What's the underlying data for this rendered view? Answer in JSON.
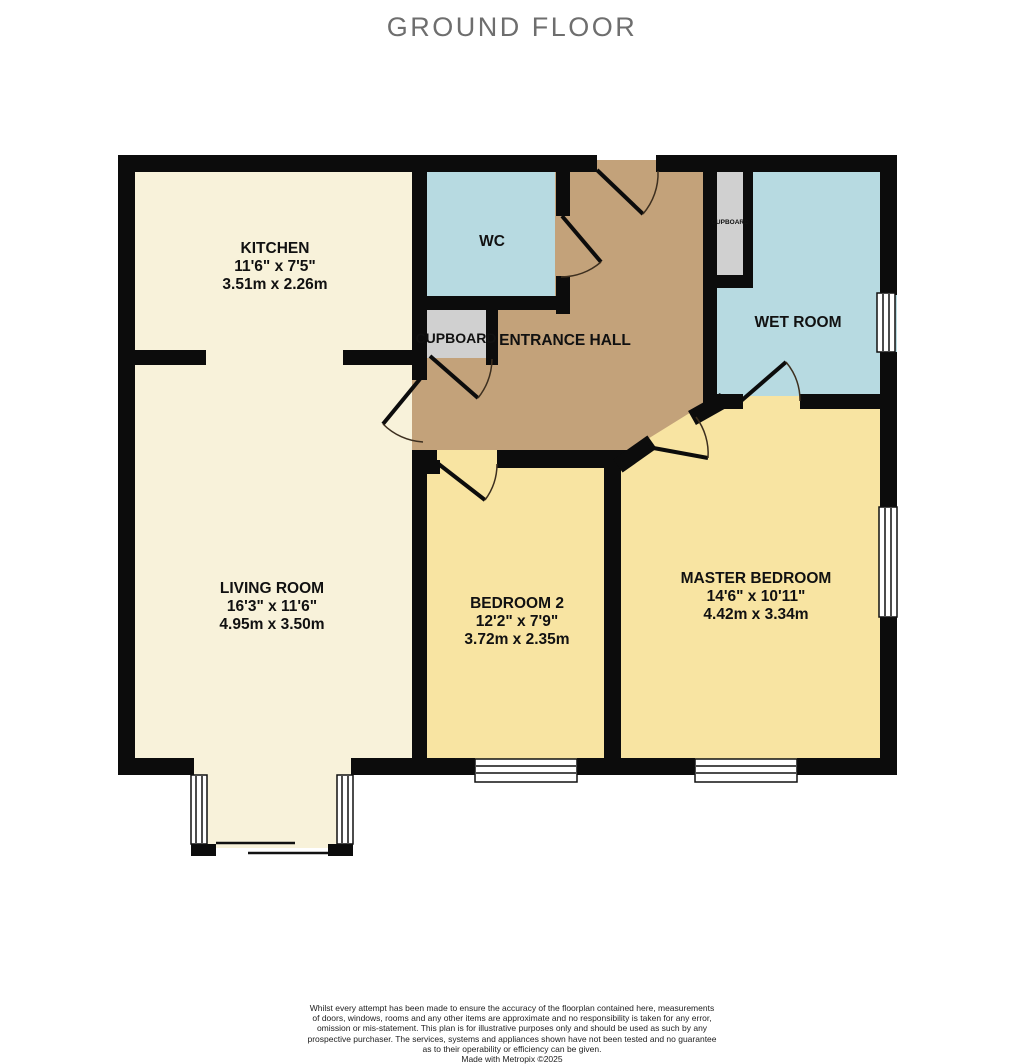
{
  "title": "GROUND FLOOR",
  "colors": {
    "wall": "#0c0c0c",
    "cream": "#f8f2da",
    "blue": "#b7dae1",
    "tan": "#c3a27a",
    "yellow": "#f8e4a2",
    "gray": "#d0d0d0",
    "door_arc": "#3d2f1f",
    "title_gray": "#6e6e6e"
  },
  "rooms": {
    "kitchen": {
      "name": "KITCHEN",
      "imperial": "11'6\" x 7'5\"",
      "metric": "3.51m x 2.26m"
    },
    "wc": {
      "name": "WC"
    },
    "entrance_hall": {
      "name": "ENTRANCE HALL"
    },
    "hall_cupboard": {
      "name": "CUPBOARD"
    },
    "small_cupboard": {
      "name": "CUPBOARD"
    },
    "wet_room": {
      "name": "WET ROOM"
    },
    "living_room": {
      "name": "LIVING ROOM",
      "imperial": "16'3\" x 11'6\"",
      "metric": "4.95m x 3.50m"
    },
    "bedroom2": {
      "name": "BEDROOM 2",
      "imperial": "12'2\" x 7'9\"",
      "metric": "3.72m x 2.35m"
    },
    "master_bedroom": {
      "name": "MASTER BEDROOM",
      "imperial": "14'6\" x 10'11\"",
      "metric": "4.42m x 3.34m"
    }
  },
  "footer": {
    "lines": [
      "Whilst every attempt has been made to ensure the accuracy of the floorplan contained here, measurements",
      "of doors, windows, rooms and any other items are approximate and no responsibility is taken for any error,",
      "omission or mis-statement. This plan is for illustrative purposes only and should be used as such by any",
      "prospective purchaser. The services, systems and appliances shown have not been tested and no guarantee",
      "as to their operability or efficiency can be given.",
      "Made with Metropix ©2025"
    ]
  }
}
